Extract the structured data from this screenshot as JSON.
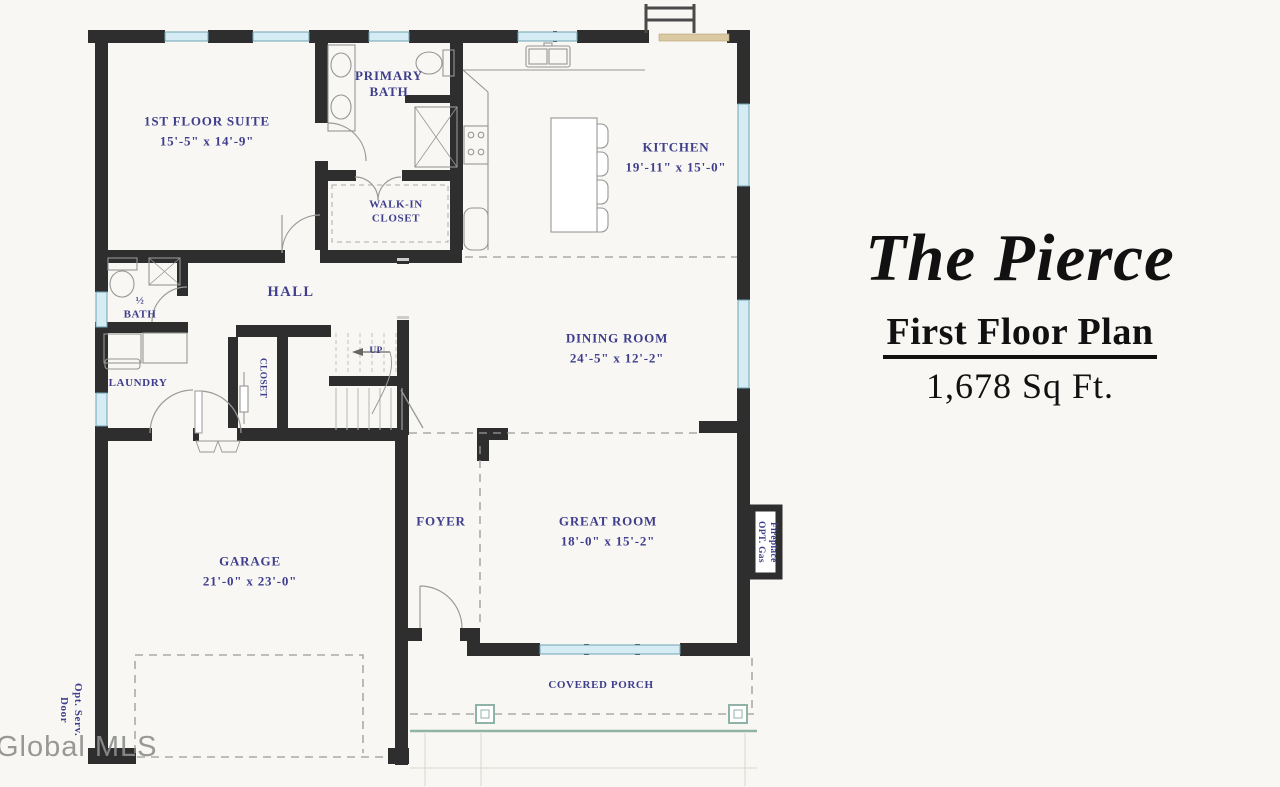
{
  "title_block": {
    "plan_name": "The Pierce",
    "subtitle": "First Floor Plan",
    "area": "1,678 Sq Ft."
  },
  "watermark": "Global MLS",
  "rooms": {
    "suite": {
      "name": "1ST FLOOR SUITE",
      "dims": "15'-5\" x 14'-9\""
    },
    "primary_bath": {
      "name": "PRIMARY BATH"
    },
    "walk_in_closet": {
      "name": "WALK-IN CLOSET"
    },
    "kitchen": {
      "name": "KITCHEN",
      "dims": "19'-11\" x 15'-0\""
    },
    "hall": {
      "name": "HALL"
    },
    "half_bath": {
      "name": "½ BATH"
    },
    "laundry": {
      "name": "LAUNDRY"
    },
    "closet": {
      "name": "CLOSET"
    },
    "stairs_up": {
      "name": "UP"
    },
    "dining_room": {
      "name": "DINING ROOM",
      "dims": "24'-5\" x 12'-2\""
    },
    "foyer": {
      "name": "FOYER"
    },
    "great_room": {
      "name": "GREAT ROOM",
      "dims": "18'-0\" x 15'-2\""
    },
    "garage": {
      "name": "GARAGE",
      "dims": "21'-0\" x 23'-0\""
    },
    "covered_porch": {
      "name": "COVERED PORCH"
    },
    "fireplace": {
      "name": "OPT. Gas Fireplace"
    },
    "service_door": {
      "name": "Opt. Serv. Door"
    }
  },
  "colors": {
    "wall": "#2e2e2e",
    "label_text": "#3e3e8c",
    "window_fill": "#d6ecf4",
    "window_frame": "#6fa3b5",
    "porch_teal": "#8fb3a6",
    "door_tan": "#dbc9a2"
  }
}
